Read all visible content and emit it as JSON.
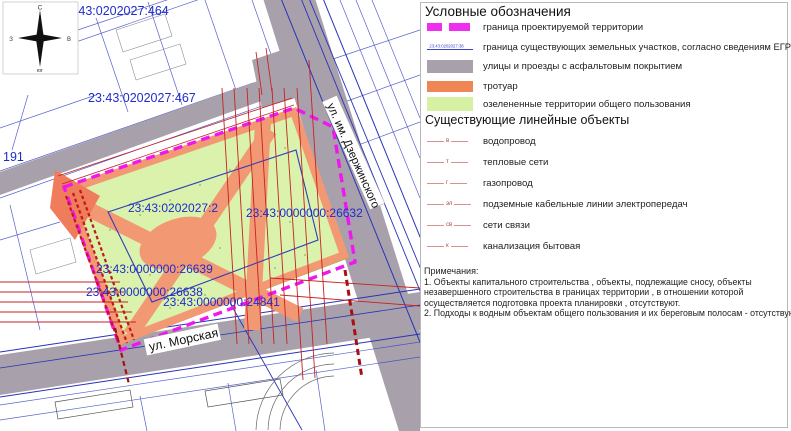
{
  "colors": {
    "project_boundary_magenta": "#ef16ef",
    "road_gray": "#a8a1ac",
    "sidewalk_orange": "#ee8656",
    "green_territory": "#d6f0a4",
    "cadastral_blue": "#1f2ccc",
    "utility_red": "#c62222"
  },
  "map": {
    "compass": {
      "north": "С",
      "west": "З",
      "east": "В",
      "south": "юг"
    },
    "parcel_labels": [
      {
        "text": "23:43:0202027:464"
      },
      {
        "text": "23:43:0202027:467"
      },
      {
        "text": "191"
      },
      {
        "text": "23:43:0202027:2"
      },
      {
        "text": "23:43:0000000:26632"
      },
      {
        "text": "23:43:0000000:26639"
      },
      {
        "text": "23:43:0000000:26638"
      },
      {
        "text": "23:43:0000000:24841"
      }
    ],
    "streets": [
      {
        "name": "ул. им. Дзержинского"
      },
      {
        "name": "ул. Морская"
      }
    ]
  },
  "legend": {
    "title": "Условные обозначения",
    "items": [
      {
        "label": "граница проектируемой территории"
      },
      {
        "label": "граница существующих земельных участков, согласно сведениям ЕГРН, номер",
        "sample_number": "23:43:0202027:38"
      },
      {
        "label": "улицы и проезды с асфальтовым покрытием"
      },
      {
        "label": "тротуар"
      },
      {
        "label": "озелененные территории общего пользования"
      }
    ],
    "linear_section_title": "Существующие линейные объекты",
    "linear_items": [
      {
        "label": "водопровод",
        "marker": "в"
      },
      {
        "label": "тепловые сети",
        "marker": "т"
      },
      {
        "label": "газопровод",
        "marker": "г"
      },
      {
        "label": "подземные кабельные линии электропередач",
        "marker": "эл"
      },
      {
        "label": "сети связи",
        "marker": "св"
      },
      {
        "label": "канализация бытовая",
        "marker": "к"
      }
    ],
    "notes": {
      "title": "Примечания:",
      "lines": [
        "1. Объекты капитального строительства , объекты, подлежащие сносу, объекты",
        "незавершенного строительства в границах территории , в отношении которой",
        "осуществляется подготовка проекта планировки , отсутствуют.",
        "2. Подходы к водным объектам общего пользования и их береговым полосам  - отсутствуют."
      ]
    }
  }
}
